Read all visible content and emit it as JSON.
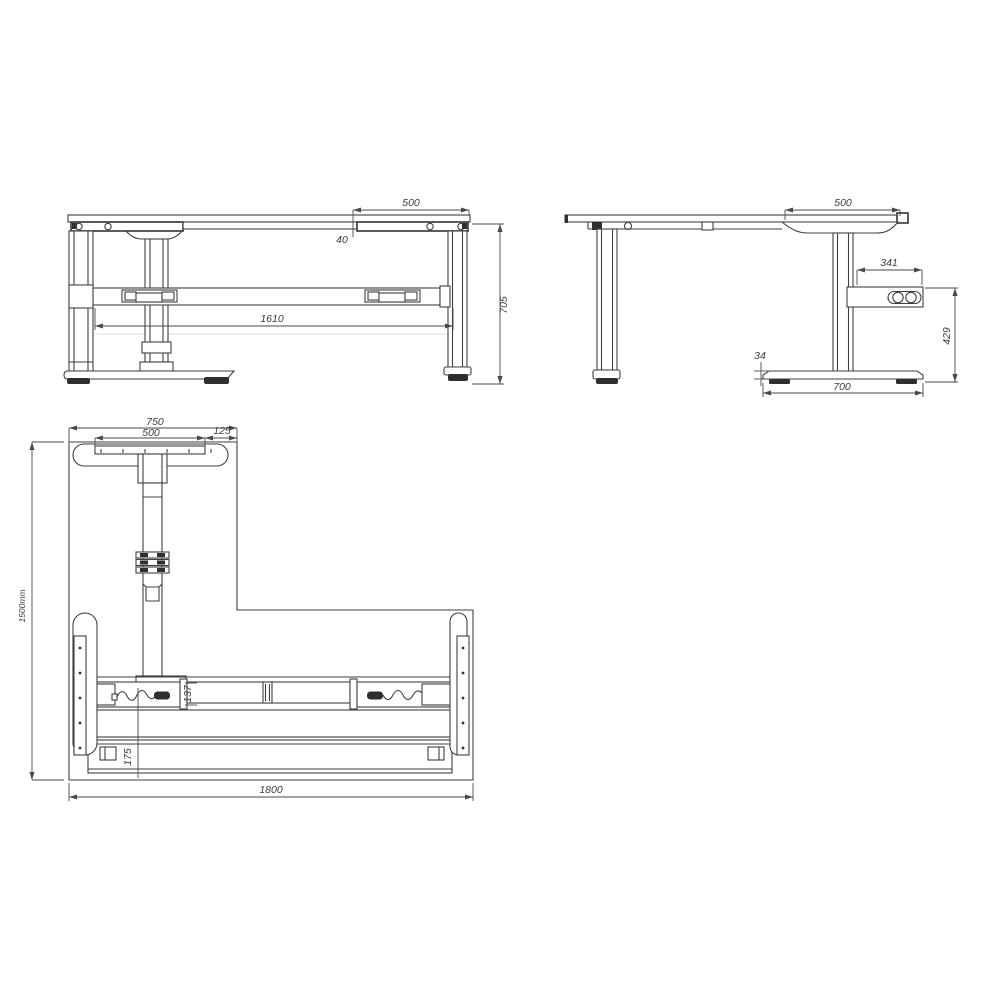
{
  "drawing": {
    "colors": {
      "background": "#ffffff",
      "line": "#3f3f3f",
      "dimension_line": "#4a4a4a",
      "text": "#3c3c3c",
      "pad_fill": "#2f2f2f"
    },
    "front_view": {
      "dims": {
        "d500": "500",
        "d40": "40",
        "d1610": "1610",
        "d705": "705"
      }
    },
    "side_view": {
      "dims": {
        "d500": "500",
        "d341": "341",
        "d429": "429",
        "d34": "34",
        "d700": "700"
      }
    },
    "plan_view": {
      "dims": {
        "d750": "750",
        "d500": "500",
        "d125": "125",
        "d1500": "1500mm",
        "d137": "137",
        "d175": "175",
        "d1800": "1800"
      }
    }
  }
}
